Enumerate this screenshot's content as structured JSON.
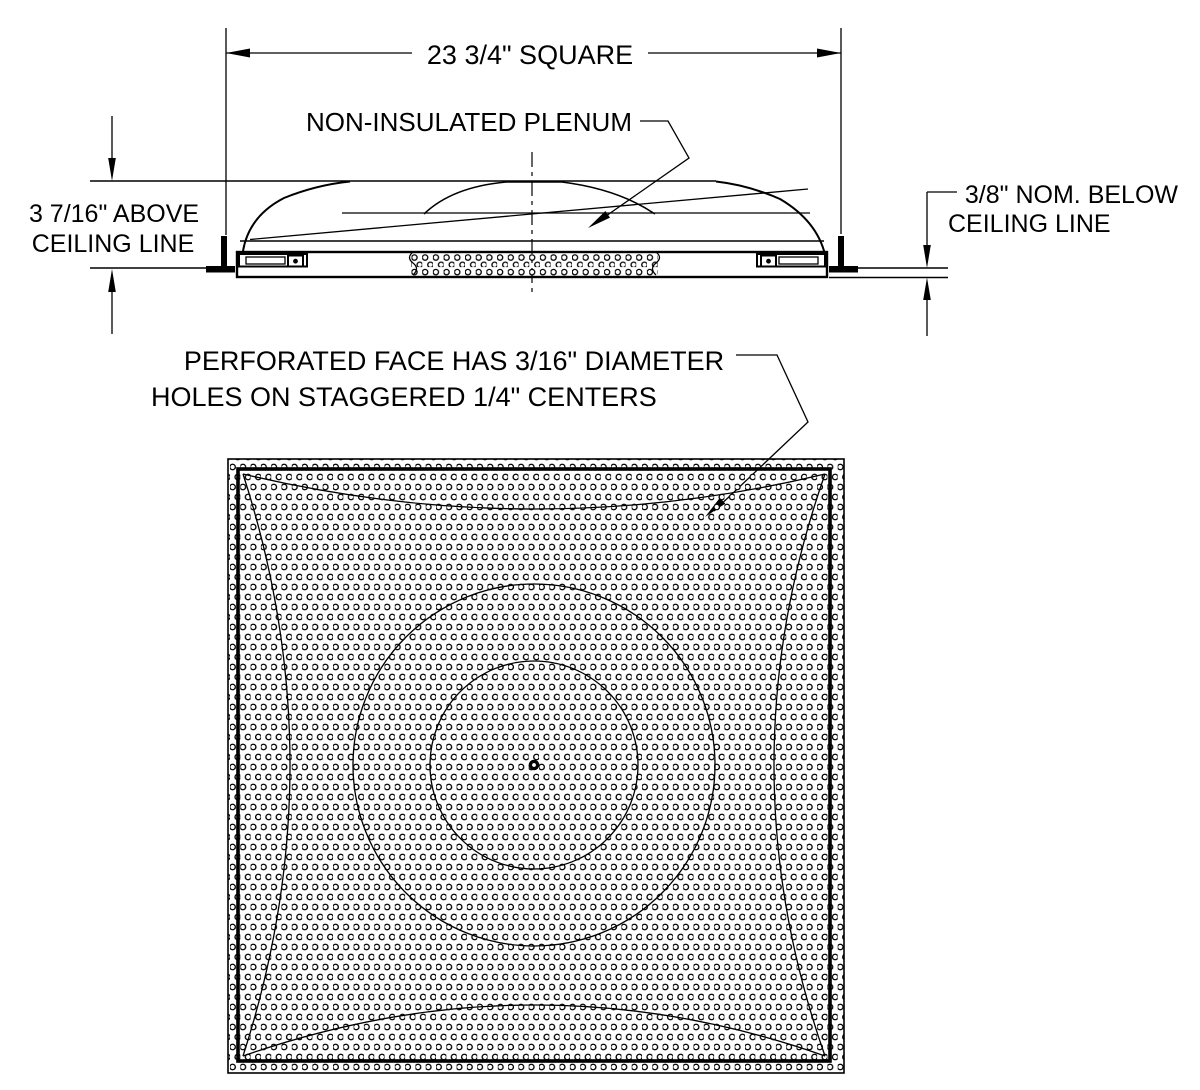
{
  "drawing": {
    "colors": {
      "ink": "#000000",
      "paper": "#ffffff"
    },
    "section_view": {
      "width_dimension": "23 3/4\" SQUARE",
      "plenum_label": "NON-INSULATED PLENUM",
      "above_dimension_line1": "3 7/16\" ABOVE",
      "above_dimension_line2": "CEILING LINE",
      "below_dimension_line1": "3/8\" NOM. BELOW",
      "below_dimension_line2": "CEILING LINE"
    },
    "plan_view": {
      "perforation_note_line1": "PERFORATED FACE HAS 3/16\" DIAMETER",
      "perforation_note_line2": "HOLES ON STAGGERED 1/4\" CENTERS"
    }
  }
}
